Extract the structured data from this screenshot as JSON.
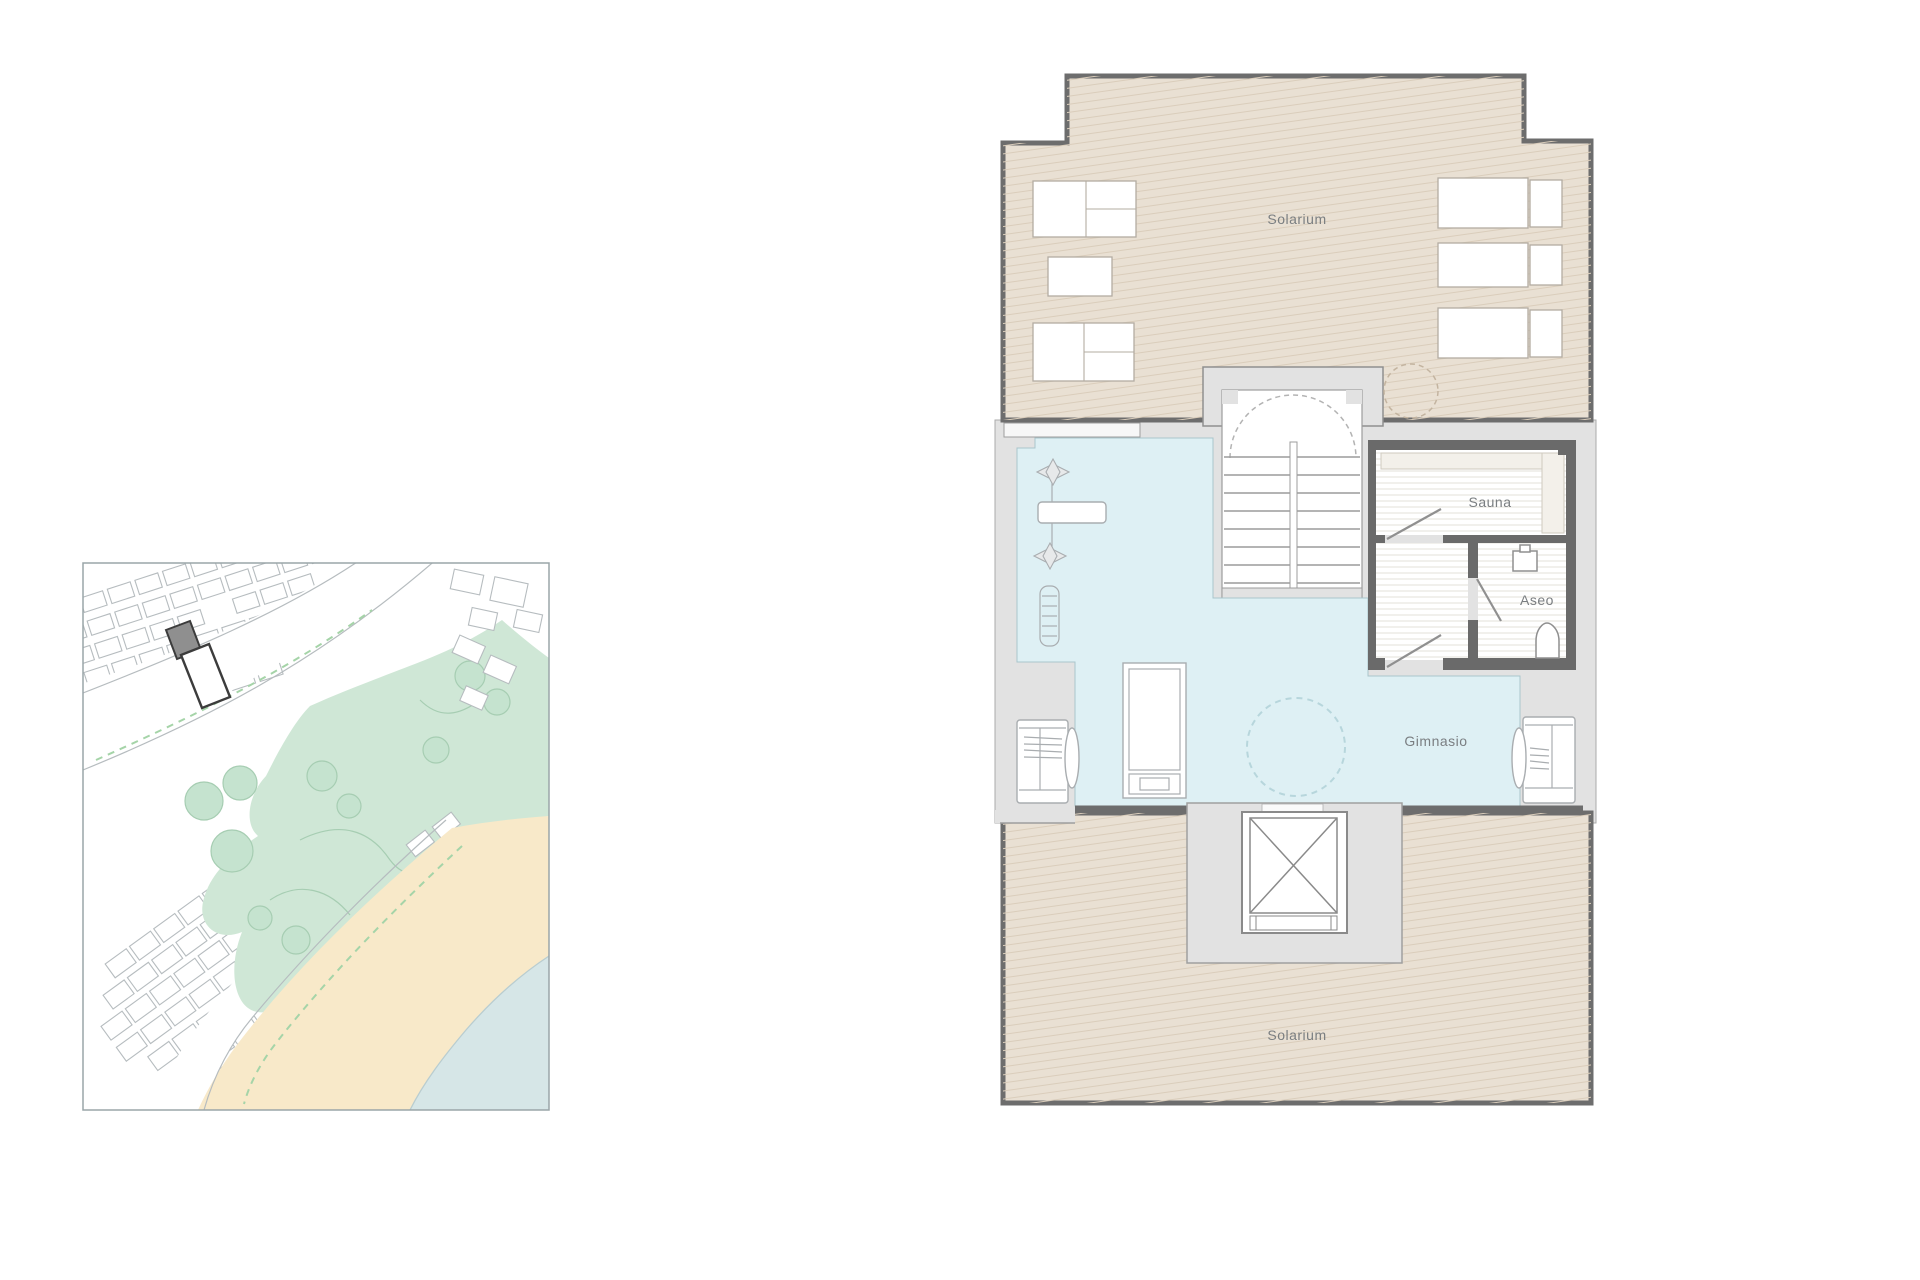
{
  "floor_plan": {
    "rooms": [
      {
        "id": "solarium-top",
        "label": "Solarium"
      },
      {
        "id": "sauna",
        "label": "Sauna"
      },
      {
        "id": "aseo",
        "label": "Aseo"
      },
      {
        "id": "gimnasio",
        "label": "Gimnasio"
      },
      {
        "id": "solarium-bottom",
        "label": "Solarium"
      }
    ]
  },
  "colors": {
    "floor_tan": "#e9e0d3",
    "tan_hatch": "#dacdbb",
    "gym_blue": "#def0f4",
    "wall_dark": "#6d6d6d",
    "wall_gray": "#e2e2e2",
    "wall_line": "#9e9e9e",
    "sauna_wall": "#6a6a6a",
    "stair_line": "#9c9c9c",
    "floor_hatch": "#e3e0da",
    "equip_line": "#a9adb0",
    "lounger_line": "#b3aca2",
    "label_gray": "#7a7e81",
    "dash_tan": "#c3b4a0",
    "dash_blue": "#b7d6dc",
    "map_border": "#9aa5a8",
    "map_line": "#b6bcbf",
    "map_green": "#cfe7d6",
    "map_green_line": "#a6cdb2",
    "map_sand": "#f8e9c9",
    "map_sea": "#d6e6e7",
    "map_dash_green": "#a5d4a8",
    "marker_fill": "#8f8f8f",
    "marker_dark": "#3c3c3c"
  }
}
